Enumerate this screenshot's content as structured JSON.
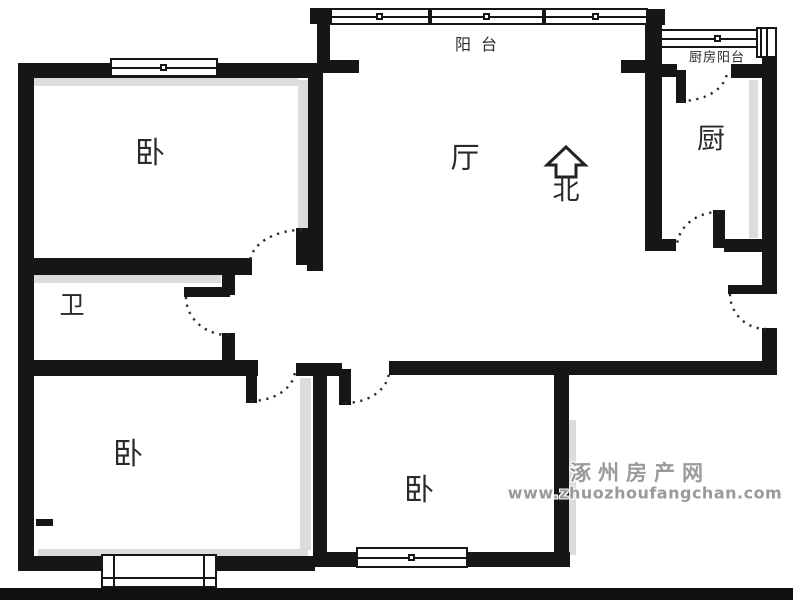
{
  "canvas": {
    "w": 793,
    "h": 600
  },
  "colors": {
    "wall": "#161616",
    "shadow": "#dcdcdc",
    "label": "#2a2a2a",
    "watermark": "#9a9a9a",
    "bottom_bar": "#101010",
    "background": "#ffffff"
  },
  "rooms": [
    {
      "id": "bedroom-top-left",
      "label": "卧",
      "x": 150,
      "y": 154,
      "size": 30,
      "spacing": 0
    },
    {
      "id": "living-room",
      "label": "厅",
      "x": 465,
      "y": 158,
      "size": 29,
      "spacing": 0
    },
    {
      "id": "bathroom",
      "label": "卫",
      "x": 72,
      "y": 305,
      "size": 25,
      "spacing": 0
    },
    {
      "id": "kitchen",
      "label": "厨",
      "x": 711,
      "y": 139,
      "size": 28,
      "spacing": 0
    },
    {
      "id": "bedroom-bottom-left",
      "label": "卧",
      "x": 128,
      "y": 455,
      "size": 30,
      "spacing": 0
    },
    {
      "id": "bedroom-bottom-center",
      "label": "卧",
      "x": 419,
      "y": 491,
      "size": 30,
      "spacing": 0
    },
    {
      "id": "balcony",
      "label": "阳台",
      "x": 481,
      "y": 45,
      "size": 16,
      "spacing": 10
    },
    {
      "id": "kitchen-balcony",
      "label": "厨房阳台",
      "x": 717,
      "y": 58,
      "size": 13,
      "spacing": 1
    }
  ],
  "compass": {
    "label": "北",
    "x": 566,
    "y": 191,
    "size": 27,
    "arrow_points": "566,147 585,165 576,165 576,177 556,177 556,165 547,165"
  },
  "watermark": {
    "line1": "涿州房产网",
    "line2": "www.zhuozhoufangchan.com",
    "x1": 640,
    "y1": 472,
    "x2": 645,
    "y2": 493
  },
  "plan": {
    "bottom_bar": {
      "x": 0,
      "y": 588,
      "w": 793,
      "h": 12
    },
    "walls": [
      {
        "x": 18,
        "y": 63,
        "w": 16,
        "h": 508
      },
      {
        "x": 18,
        "y": 63,
        "w": 302,
        "h": 15
      },
      {
        "x": 308,
        "y": 63,
        "w": 15,
        "h": 208
      },
      {
        "x": 310,
        "y": 8,
        "w": 18,
        "h": 16
      },
      {
        "x": 317,
        "y": 8,
        "w": 13,
        "h": 62
      },
      {
        "x": 645,
        "y": 9,
        "w": 20,
        "h": 16
      },
      {
        "x": 317,
        "y": 60,
        "w": 42,
        "h": 13
      },
      {
        "x": 621,
        "y": 60,
        "w": 26,
        "h": 13
      },
      {
        "x": 645,
        "y": 9,
        "w": 17,
        "h": 242
      },
      {
        "x": 645,
        "y": 239,
        "w": 31,
        "h": 12
      },
      {
        "x": 660,
        "y": 64,
        "w": 17,
        "h": 13
      },
      {
        "x": 731,
        "y": 64,
        "w": 46,
        "h": 14
      },
      {
        "x": 762,
        "y": 55,
        "w": 15,
        "h": 239
      },
      {
        "x": 762,
        "y": 328,
        "w": 15,
        "h": 46
      },
      {
        "x": 724,
        "y": 239,
        "w": 53,
        "h": 13
      },
      {
        "x": 389,
        "y": 361,
        "w": 388,
        "h": 14
      },
      {
        "x": 296,
        "y": 363,
        "w": 46,
        "h": 13
      },
      {
        "x": 313,
        "y": 363,
        "w": 14,
        "h": 196
      },
      {
        "x": 18,
        "y": 258,
        "w": 234,
        "h": 17
      },
      {
        "x": 307,
        "y": 257,
        "w": 16,
        "h": 14
      },
      {
        "x": 222,
        "y": 275,
        "w": 13,
        "h": 20
      },
      {
        "x": 222,
        "y": 333,
        "w": 13,
        "h": 29
      },
      {
        "x": 18,
        "y": 360,
        "w": 240,
        "h": 16
      },
      {
        "x": 554,
        "y": 361,
        "w": 15,
        "h": 200
      },
      {
        "x": 18,
        "y": 556,
        "w": 297,
        "h": 15
      },
      {
        "x": 313,
        "y": 552,
        "w": 257,
        "h": 15
      },
      {
        "x": 36,
        "y": 519,
        "w": 17,
        "h": 7
      }
    ],
    "door_leaves": [
      {
        "id": "bedroom-top-left-door-leaf",
        "x": 296,
        "y": 228,
        "w": 12,
        "h": 37
      },
      {
        "id": "bathroom-door-leaf",
        "x": 184,
        "y": 287,
        "w": 46,
        "h": 10
      },
      {
        "id": "bedroom-bottom-left-door-leaf",
        "x": 246,
        "y": 368,
        "w": 11,
        "h": 35
      },
      {
        "id": "bedroom-bottom-center-door-leaf",
        "x": 339,
        "y": 369,
        "w": 12,
        "h": 36
      },
      {
        "id": "kitchen-door-leaf",
        "x": 713,
        "y": 210,
        "w": 12,
        "h": 38
      },
      {
        "id": "kitchen-balcony-door-leaf",
        "x": 676,
        "y": 70,
        "w": 10,
        "h": 33
      },
      {
        "id": "entrance-door-leaf",
        "x": 728,
        "y": 285,
        "w": 42,
        "h": 9
      }
    ],
    "door_arcs": [
      {
        "id": "bedroom-top-left-door-arc",
        "x1": 302,
        "y1": 230,
        "x2": 250,
        "y2": 263,
        "rx": 52,
        "ry": 33,
        "sweep": 0
      },
      {
        "id": "bathroom-door-arc",
        "x1": 186,
        "y1": 297,
        "x2": 228,
        "y2": 335,
        "rx": 42,
        "ry": 38,
        "sweep": 0
      },
      {
        "id": "bedroom-bottom-left-door-arc",
        "x1": 251,
        "y1": 401,
        "x2": 295,
        "y2": 370,
        "rx": 44,
        "ry": 31,
        "sweep": 0
      },
      {
        "id": "bedroom-bottom-center-door-arc",
        "x1": 345,
        "y1": 403,
        "x2": 389,
        "y2": 371,
        "rx": 44,
        "ry": 32,
        "sweep": 0
      },
      {
        "id": "kitchen-door-arc",
        "x1": 719,
        "y1": 212,
        "x2": 677,
        "y2": 247,
        "rx": 42,
        "ry": 35,
        "sweep": 0
      },
      {
        "id": "kitchen-balcony-door-arc",
        "x1": 681,
        "y1": 101,
        "x2": 727,
        "y2": 71,
        "rx": 46,
        "ry": 30,
        "sweep": 0
      },
      {
        "id": "entrance-door-arc",
        "x1": 730,
        "y1": 294,
        "x2": 766,
        "y2": 329,
        "rx": 36,
        "ry": 35,
        "sweep": 0
      }
    ],
    "windows": [
      {
        "id": "bedroom-top-left-window",
        "t": "h",
        "x": 110,
        "y": 58,
        "w": 108,
        "h": 19,
        "sq": 1
      },
      {
        "id": "balcony-window-1",
        "t": "h",
        "x": 330,
        "y": 8,
        "w": 100,
        "h": 17,
        "sq": 1
      },
      {
        "id": "balcony-window-2",
        "t": "h",
        "x": 430,
        "y": 8,
        "w": 114,
        "h": 17,
        "sq": 1
      },
      {
        "id": "balcony-window-3",
        "t": "h",
        "x": 544,
        "y": 8,
        "w": 104,
        "h": 17,
        "sq": 1
      },
      {
        "id": "kitchen-balcony-window",
        "t": "h",
        "x": 660,
        "y": 29,
        "w": 116,
        "h": 19,
        "sq": 1
      },
      {
        "id": "kitchen-balcony-side-window",
        "t": "v",
        "x": 756,
        "y": 27,
        "w": 21,
        "h": 31,
        "sq": 0
      },
      {
        "id": "bedroom-bottom-left-bay-window",
        "t": "bay",
        "x": 101,
        "y": 554,
        "w": 116,
        "h": 34,
        "sq": 0
      },
      {
        "id": "bedroom-bottom-center-window",
        "t": "h",
        "x": 356,
        "y": 547,
        "w": 112,
        "h": 21,
        "sq": 1
      }
    ],
    "shadows": [
      {
        "x": 298,
        "y": 80,
        "w": 10,
        "h": 176
      },
      {
        "x": 33,
        "y": 78,
        "w": 265,
        "h": 8
      },
      {
        "x": 33,
        "y": 275,
        "w": 188,
        "h": 8
      },
      {
        "x": 300,
        "y": 378,
        "w": 11,
        "h": 172
      },
      {
        "x": 749,
        "y": 80,
        "w": 9,
        "h": 158
      },
      {
        "x": 569,
        "y": 420,
        "w": 7,
        "h": 135
      },
      {
        "x": 38,
        "y": 549,
        "w": 270,
        "h": 7
      }
    ]
  }
}
